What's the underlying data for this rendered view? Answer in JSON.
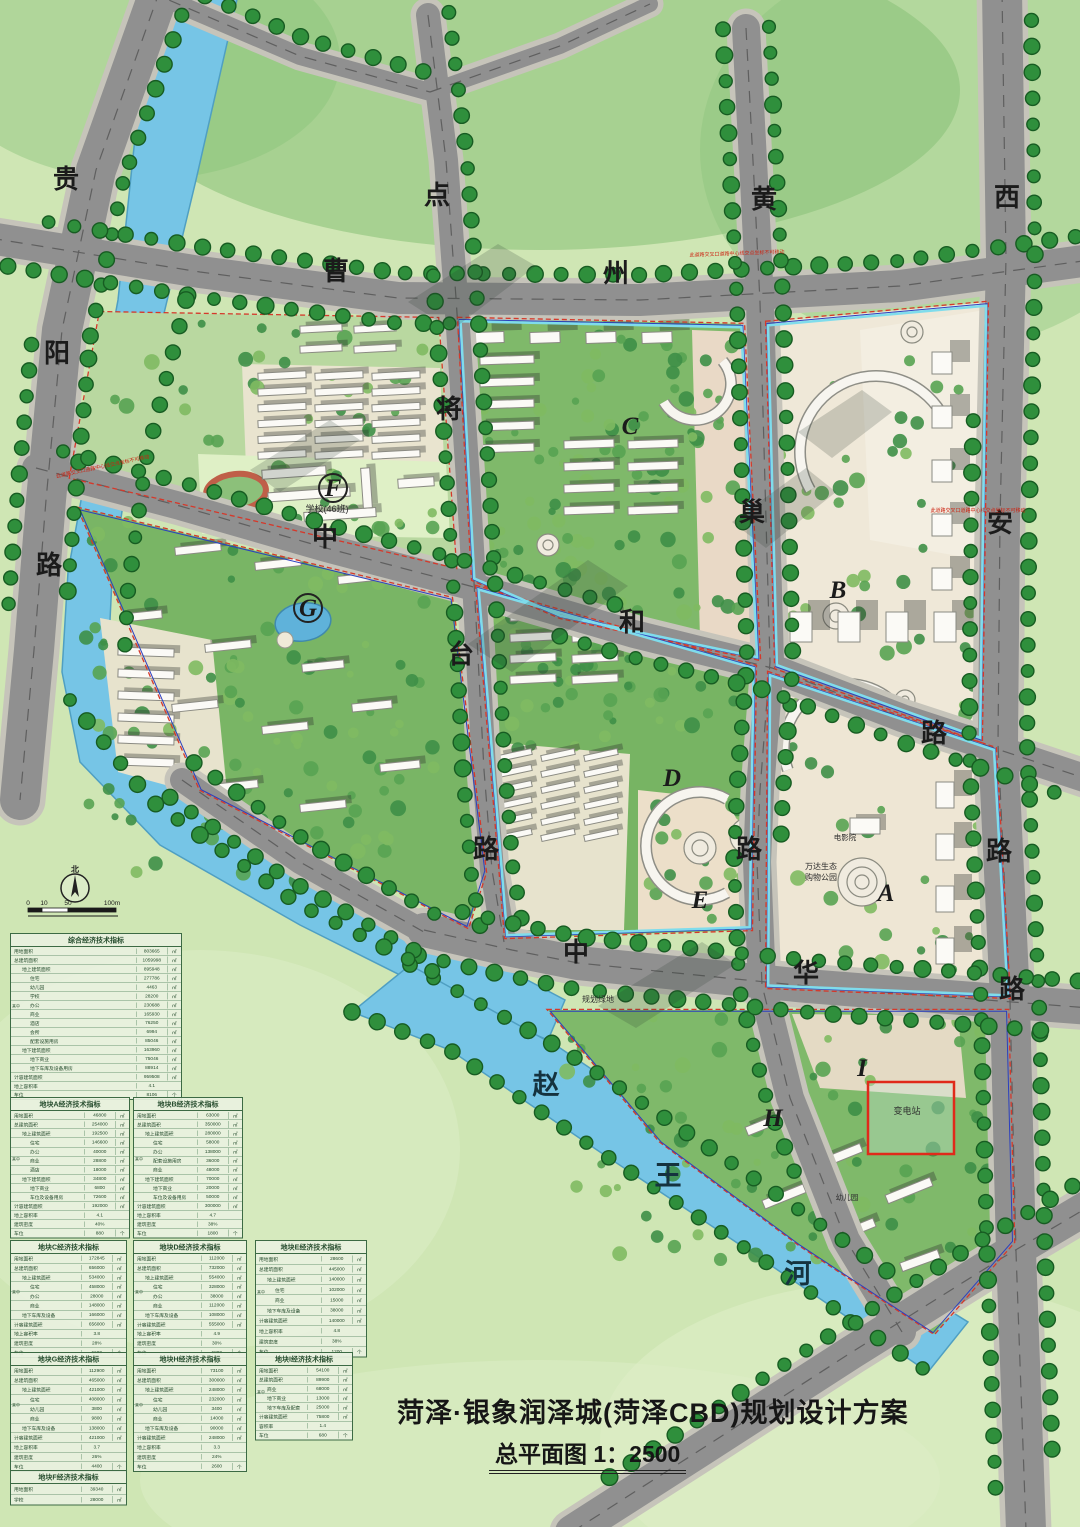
{
  "doc": {
    "title": "菏泽·银象润泽城(菏泽CBD)规划设计方案",
    "subtitle": "总平面图 1：2500"
  },
  "map": {
    "roads": [
      {
        "name": "贵阳路",
        "chars": [
          {
            "ch": "贵",
            "x": 66,
            "y": 188
          },
          {
            "ch": "阳",
            "x": 57,
            "y": 362
          },
          {
            "ch": "路",
            "x": 49,
            "y": 574
          }
        ]
      },
      {
        "name": "曹州路",
        "chars": [
          {
            "ch": "曹",
            "x": 336,
            "y": 280
          },
          {
            "ch": "州",
            "x": 616,
            "y": 282
          }
        ]
      },
      {
        "name": "点将台路",
        "chars": [
          {
            "ch": "点",
            "x": 437,
            "y": 204
          },
          {
            "ch": "将",
            "x": 449,
            "y": 418
          },
          {
            "ch": "台",
            "x": 461,
            "y": 663
          },
          {
            "ch": "路",
            "x": 486,
            "y": 858
          }
        ]
      },
      {
        "name": "黄巢路",
        "chars": [
          {
            "ch": "黄",
            "x": 764,
            "y": 208
          },
          {
            "ch": "巢",
            "x": 752,
            "y": 521
          },
          {
            "ch": "路",
            "x": 749,
            "y": 858
          }
        ]
      },
      {
        "name": "西安路",
        "chars": [
          {
            "ch": "西",
            "x": 1007,
            "y": 206
          },
          {
            "ch": "安",
            "x": 1000,
            "y": 532
          },
          {
            "ch": "路",
            "x": 999,
            "y": 860
          }
        ]
      },
      {
        "name": "中和路",
        "chars": [
          {
            "ch": "中",
            "x": 325,
            "y": 546
          },
          {
            "ch": "和",
            "x": 632,
            "y": 631
          },
          {
            "ch": "路",
            "x": 934,
            "y": 742
          }
        ]
      },
      {
        "name": "中华路",
        "chars": [
          {
            "ch": "中",
            "x": 576,
            "y": 961
          },
          {
            "ch": "华",
            "x": 806,
            "y": 982
          },
          {
            "ch": "路",
            "x": 1012,
            "y": 998
          }
        ]
      }
    ],
    "river": {
      "name": "赵王河",
      "chars": [
        {
          "ch": "赵",
          "x": 546,
          "y": 1094
        },
        {
          "ch": "王",
          "x": 668,
          "y": 1185
        },
        {
          "ch": "河",
          "x": 798,
          "y": 1283
        }
      ]
    },
    "blocks": [
      {
        "id": "A",
        "x": 886,
        "y": 901,
        "circled": false
      },
      {
        "id": "B",
        "x": 838,
        "y": 598,
        "circled": false
      },
      {
        "id": "C",
        "x": 630,
        "y": 434,
        "circled": false
      },
      {
        "id": "D",
        "x": 672,
        "y": 786,
        "circled": false
      },
      {
        "id": "E",
        "x": 700,
        "y": 908,
        "circled": false
      },
      {
        "id": "F",
        "x": 333,
        "y": 496,
        "circled": true
      },
      {
        "id": "G",
        "x": 308,
        "y": 616,
        "circled": true
      },
      {
        "id": "H",
        "x": 773,
        "y": 1126,
        "circled": false
      },
      {
        "id": "I",
        "x": 862,
        "y": 1076,
        "circled": false
      }
    ],
    "places": [
      {
        "text": "学校(46班)",
        "x": 327,
        "y": 512,
        "size": 9
      },
      {
        "text": "规划绿地",
        "x": 598,
        "y": 1002,
        "size": 8
      },
      {
        "text": "万达生态",
        "x": 821,
        "y": 869,
        "size": 8
      },
      {
        "text": "购物公园",
        "x": 821,
        "y": 880,
        "size": 8
      },
      {
        "text": "电影院",
        "x": 845,
        "y": 840,
        "size": 7.5
      },
      {
        "text": "幼儿园",
        "x": 847,
        "y": 1200,
        "size": 7.5
      },
      {
        "text": "变电站",
        "x": 907,
        "y": 1114,
        "size": 9
      }
    ],
    "notes": [
      {
        "text": "此道路交叉口道路中心线交点坐标不可移动",
        "x": 103,
        "y": 468,
        "rot": -12
      },
      {
        "text": "此道路交叉口道路中心线交点坐标不可移动",
        "x": 737,
        "y": 255,
        "rot": -2
      },
      {
        "text": "此道路交叉口道路中心线交点坐标不可移动",
        "x": 978,
        "y": 512,
        "rot": 0
      }
    ],
    "compass": {
      "label": "北"
    },
    "scale_ticks": [
      "0",
      "10",
      "50",
      "100m"
    ]
  },
  "tables": [
    {
      "id": "comprehensive",
      "title": "综合经济技术指标",
      "x": 10,
      "y": 933,
      "w": 172,
      "h": 156,
      "group_label": "其中",
      "rows": [
        [
          0,
          "用地面积",
          "803665",
          "㎡"
        ],
        [
          0,
          "总建筑面积",
          "1059998",
          "㎡"
        ],
        [
          1,
          "地上建筑面积",
          "895948",
          "㎡"
        ],
        [
          2,
          "住宅",
          "277786",
          "㎡"
        ],
        [
          2,
          "幼儿园",
          "4463",
          "㎡"
        ],
        [
          2,
          "学校",
          "28200",
          "㎡"
        ],
        [
          2,
          "办公",
          "230688",
          "㎡"
        ],
        [
          2,
          "商业",
          "165930",
          "㎡"
        ],
        [
          2,
          "酒店",
          "76250",
          "㎡"
        ],
        [
          2,
          "会所",
          "6994",
          "㎡"
        ],
        [
          2,
          "配套设施用房",
          "85046",
          "㎡"
        ],
        [
          1,
          "地下建筑面积",
          "163960",
          "㎡"
        ],
        [
          2,
          "地下商业",
          "75046",
          "㎡"
        ],
        [
          2,
          "地下车库及设备用房",
          "88914",
          "㎡"
        ],
        [
          0,
          "计容建筑面积",
          "959508",
          "㎡"
        ],
        [
          0,
          "地上容积率",
          "4.1",
          ""
        ],
        [
          0,
          "车位",
          "8106",
          "个"
        ]
      ]
    },
    {
      "id": "A",
      "title": "地块A经济技术指标",
      "x": 10,
      "y": 1097,
      "w": 120,
      "h": 132,
      "group_label": "其中",
      "rows": [
        [
          0,
          "用地面积",
          "46800",
          "㎡"
        ],
        [
          0,
          "总建筑面积",
          "254000",
          "㎡"
        ],
        [
          1,
          "地上建筑面积",
          "192500",
          "㎡"
        ],
        [
          2,
          "住宅",
          "146600",
          "㎡"
        ],
        [
          2,
          "办公",
          "40000",
          "㎡"
        ],
        [
          2,
          "商业",
          "28800",
          "㎡"
        ],
        [
          2,
          "酒店",
          "18000",
          "㎡"
        ],
        [
          1,
          "地下建筑面积",
          "34800",
          "㎡"
        ],
        [
          2,
          "地下商业",
          "6800",
          "㎡"
        ],
        [
          2,
          "车位及设备用房",
          "72600",
          "㎡"
        ],
        [
          0,
          "计容建筑面积",
          "192000",
          "㎡"
        ],
        [
          0,
          "地上容积率",
          "4.1",
          ""
        ],
        [
          0,
          "建筑密度",
          "40%",
          ""
        ],
        [
          0,
          "车位",
          "880",
          "个"
        ]
      ]
    },
    {
      "id": "B",
      "title": "地块B经济技术指标",
      "x": 133,
      "y": 1097,
      "w": 110,
      "h": 132,
      "group_label": "其中",
      "rows": [
        [
          0,
          "用地面积",
          "63000",
          "㎡"
        ],
        [
          0,
          "总建筑面积",
          "350000",
          "㎡"
        ],
        [
          1,
          "地上建筑面积",
          "280000",
          "㎡"
        ],
        [
          2,
          "住宅",
          "58000",
          "㎡"
        ],
        [
          2,
          "办公",
          "138000",
          "㎡"
        ],
        [
          2,
          "配套设施用房",
          "36000",
          "㎡"
        ],
        [
          2,
          "商业",
          "48000",
          "㎡"
        ],
        [
          1,
          "地下建筑面积",
          "70000",
          "㎡"
        ],
        [
          2,
          "地下商业",
          "20000",
          "㎡"
        ],
        [
          2,
          "车位及设备用房",
          "50000",
          "㎡"
        ],
        [
          0,
          "计容建筑面积",
          "300000",
          "㎡"
        ],
        [
          0,
          "地上容积率",
          "4.7",
          ""
        ],
        [
          0,
          "建筑密度",
          "38%",
          ""
        ],
        [
          0,
          "车位",
          "1800",
          "个"
        ]
      ]
    },
    {
      "id": "C",
      "title": "地块C经济技术指标",
      "x": 10,
      "y": 1240,
      "w": 117,
      "h": 110,
      "group_label": "其中",
      "rows": [
        [
          0,
          "用地面积",
          "172845",
          "㎡"
        ],
        [
          0,
          "总建筑面积",
          "656000",
          "㎡"
        ],
        [
          1,
          "地上建筑面积",
          "534000",
          "㎡"
        ],
        [
          2,
          "住宅",
          "458000",
          "㎡"
        ],
        [
          2,
          "办公",
          "28000",
          "㎡"
        ],
        [
          2,
          "商业",
          "148000",
          "㎡"
        ],
        [
          1,
          "地下车库及设备",
          "166000",
          "㎡"
        ],
        [
          0,
          "计容建筑面积",
          "656000",
          "㎡"
        ],
        [
          0,
          "地上容积率",
          "3.8",
          ""
        ],
        [
          0,
          "建筑密度",
          "28%",
          ""
        ],
        [
          0,
          "车位",
          "6600",
          "个"
        ]
      ]
    },
    {
      "id": "D",
      "title": "地块D经济技术指标",
      "x": 133,
      "y": 1240,
      "w": 114,
      "h": 110,
      "group_label": "其中",
      "rows": [
        [
          0,
          "用地面积",
          "112000",
          "㎡"
        ],
        [
          0,
          "总建筑面积",
          "732000",
          "㎡"
        ],
        [
          1,
          "地上建筑面积",
          "554000",
          "㎡"
        ],
        [
          2,
          "住宅",
          "328000",
          "㎡"
        ],
        [
          2,
          "办公",
          "38000",
          "㎡"
        ],
        [
          2,
          "商业",
          "112000",
          "㎡"
        ],
        [
          1,
          "地下车库及设备",
          "108000",
          "㎡"
        ],
        [
          0,
          "计容建筑面积",
          "555000",
          "㎡"
        ],
        [
          0,
          "地上容积率",
          "4.9",
          ""
        ],
        [
          0,
          "建筑密度",
          "30%",
          ""
        ],
        [
          0,
          "车位",
          "6800",
          "个"
        ]
      ]
    },
    {
      "id": "E",
      "title": "地块E经济技术指标",
      "x": 255,
      "y": 1240,
      "w": 112,
      "h": 110,
      "group_label": "其中",
      "rows": [
        [
          0,
          "用地面积",
          "28600",
          "㎡"
        ],
        [
          0,
          "总建筑面积",
          "445000",
          "㎡"
        ],
        [
          1,
          "地上建筑面积",
          "140000",
          "㎡"
        ],
        [
          2,
          "住宅",
          "102000",
          "㎡"
        ],
        [
          2,
          "商业",
          "15000",
          "㎡"
        ],
        [
          1,
          "地下车库及设备",
          "38000",
          "㎡"
        ],
        [
          0,
          "计容建筑面积",
          "140000",
          "㎡"
        ],
        [
          0,
          "地上容积率",
          "4.8",
          ""
        ],
        [
          0,
          "建筑密度",
          "38%",
          ""
        ],
        [
          0,
          "车位",
          "1200",
          "个"
        ]
      ]
    },
    {
      "id": "G",
      "title": "地块G经济技术指标",
      "x": 10,
      "y": 1352,
      "w": 117,
      "h": 112,
      "group_label": "其中",
      "rows": [
        [
          0,
          "用地面积",
          "112900",
          "㎡"
        ],
        [
          0,
          "总建筑面积",
          "465000",
          "㎡"
        ],
        [
          1,
          "地上建筑面积",
          "421000",
          "㎡"
        ],
        [
          2,
          "住宅",
          "408000",
          "㎡"
        ],
        [
          2,
          "幼儿园",
          "3800",
          "㎡"
        ],
        [
          2,
          "商业",
          "9800",
          "㎡"
        ],
        [
          1,
          "地下车库及设备",
          "138000",
          "㎡"
        ],
        [
          0,
          "计容建筑面积",
          "421000",
          "㎡"
        ],
        [
          0,
          "地上容积率",
          "3.7",
          ""
        ],
        [
          0,
          "建筑密度",
          "26%",
          ""
        ],
        [
          0,
          "车位",
          "4400",
          "个"
        ]
      ]
    },
    {
      "id": "H",
      "title": "地块H经济技术指标",
      "x": 133,
      "y": 1352,
      "w": 114,
      "h": 112,
      "group_label": "其中",
      "rows": [
        [
          0,
          "用地面积",
          "73100",
          "㎡"
        ],
        [
          0,
          "总建筑面积",
          "300000",
          "㎡"
        ],
        [
          1,
          "地上建筑面积",
          "248000",
          "㎡"
        ],
        [
          2,
          "住宅",
          "232000",
          "㎡"
        ],
        [
          2,
          "幼儿园",
          "3400",
          "㎡"
        ],
        [
          2,
          "商业",
          "14000",
          "㎡"
        ],
        [
          1,
          "地下车库及设备",
          "90000",
          "㎡"
        ],
        [
          0,
          "计容建筑面积",
          "248000",
          "㎡"
        ],
        [
          0,
          "地上容积率",
          "3.3",
          ""
        ],
        [
          0,
          "建筑密度",
          "24%",
          ""
        ],
        [
          0,
          "车位",
          "2600",
          "个"
        ]
      ]
    },
    {
      "id": "I",
      "title": "地块I经济技术指标",
      "x": 255,
      "y": 1352,
      "w": 98,
      "h": 82,
      "group_label": "其中",
      "rows": [
        [
          0,
          "用地面积",
          "54100",
          "㎡"
        ],
        [
          0,
          "总建筑面积",
          "89900",
          "㎡"
        ],
        [
          1,
          "商业",
          "68000",
          "㎡"
        ],
        [
          1,
          "地下商业",
          "13000",
          "㎡"
        ],
        [
          1,
          "地下车库及配套",
          "25000",
          "㎡"
        ],
        [
          0,
          "计容建筑面积",
          "75800",
          "㎡"
        ],
        [
          0,
          "容积率",
          "1.4",
          ""
        ],
        [
          0,
          "车位",
          "680",
          "个"
        ]
      ]
    },
    {
      "id": "F",
      "title": "地块F经济技术指标",
      "x": 10,
      "y": 1470,
      "w": 117,
      "h": 32,
      "group_label": "",
      "rows": [
        [
          0,
          "用地面积",
          "39340",
          "㎡"
        ],
        [
          0,
          "学校",
          "28000",
          "㎡"
        ]
      ]
    }
  ],
  "colors": {
    "water": "#76c5e6",
    "road": "#909090",
    "tree": "#2f8f3c",
    "residential_green": "#7fb96a",
    "plaza": "#efe8d8",
    "boundary_red": "#d5392b",
    "boundary_blue": "#2b3fbf",
    "boundary_cyan": "#7fdcec",
    "table_text": "#234a2b",
    "note_red": "#cc2211"
  }
}
